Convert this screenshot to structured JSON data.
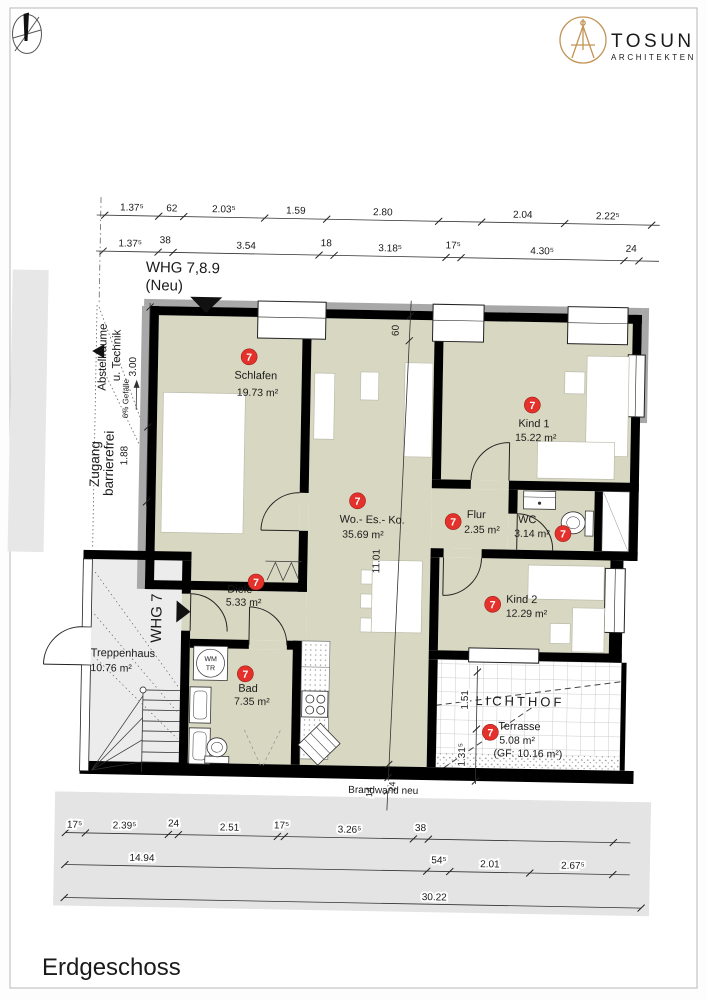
{
  "meta": {
    "floor_title": "Erdgeschoss"
  },
  "logo": {
    "brand": "TOSUN",
    "tagline": "ARCHITEKTEN"
  },
  "labels": {
    "whg_line1": "WHG 7,8.9",
    "whg_line2": "(Neu)",
    "whg7": "WHG 7",
    "abstell_1": "Abstellräume",
    "abstell_2": "u. Technik",
    "gefaelle": "6% Gefälle",
    "zugang_1": "Zugang",
    "zugang_2": "barrierefrei",
    "lichthof": "LICHTHOF",
    "brandwand": "Brandwand neu",
    "wm": "WM",
    "tr": "TR"
  },
  "rooms": [
    {
      "key": "schlafen",
      "name": "Schlafen",
      "area": "19.73 m²",
      "marker": "7"
    },
    {
      "key": "kind1",
      "name": "Kind 1",
      "area": "15.22 m²",
      "marker": "7"
    },
    {
      "key": "woesko",
      "name": "Wo.- Es.- Ko.",
      "area": "35.69 m²",
      "marker": "7"
    },
    {
      "key": "flur",
      "name": "Flur",
      "area": "2.35 m²",
      "marker": "7"
    },
    {
      "key": "wc",
      "name": "WC",
      "area": "3.14 m²",
      "marker": "7"
    },
    {
      "key": "kind2",
      "name": "Kind 2",
      "area": "12.29 m²",
      "marker": "7"
    },
    {
      "key": "diele",
      "name": "Diele",
      "area": "5.33 m²",
      "marker": "7"
    },
    {
      "key": "bad",
      "name": "Bad",
      "area": "7.35 m²",
      "marker": "7"
    },
    {
      "key": "treppenhaus",
      "name": "Treppenhaus",
      "area": "10.76 m²",
      "marker": ""
    },
    {
      "key": "terrasse",
      "name": "Terrasse",
      "area": "5.08 m²",
      "area_gf": "(GF: 10.16 m²)",
      "marker": "7"
    }
  ],
  "dimensions": {
    "top_row1": [
      "1.37⁵",
      "62",
      "2.03⁵",
      "1.59",
      "2.80",
      "2.04",
      "2.22⁵"
    ],
    "top_row2": [
      "1.37⁵",
      "38",
      "3.54",
      "18",
      "3.18⁵",
      "17⁵",
      "4.30⁵",
      "24"
    ],
    "left_v": [
      "3.00",
      "1.88"
    ],
    "center_v": [
      "60",
      "11.01",
      "14",
      "24"
    ],
    "terrace_v": [
      "1.51",
      "1.31⁵"
    ],
    "bottom_row1": [
      "17⁵",
      "2.39⁵",
      "24",
      "2.51",
      "17⁵",
      "3.26⁵",
      "38"
    ],
    "bottom_row2": [
      "14.94",
      "54⁵",
      "2.01",
      "2.67⁵"
    ],
    "bottom_total": "30.22"
  },
  "colors": {
    "room_fill": "#d8d8c2",
    "stair_fill": "#ececec",
    "marker_red": "#e5312b",
    "logo_gold": "#c29455",
    "wall_black": "#000000",
    "ground_gray": "#e4e4e4"
  }
}
